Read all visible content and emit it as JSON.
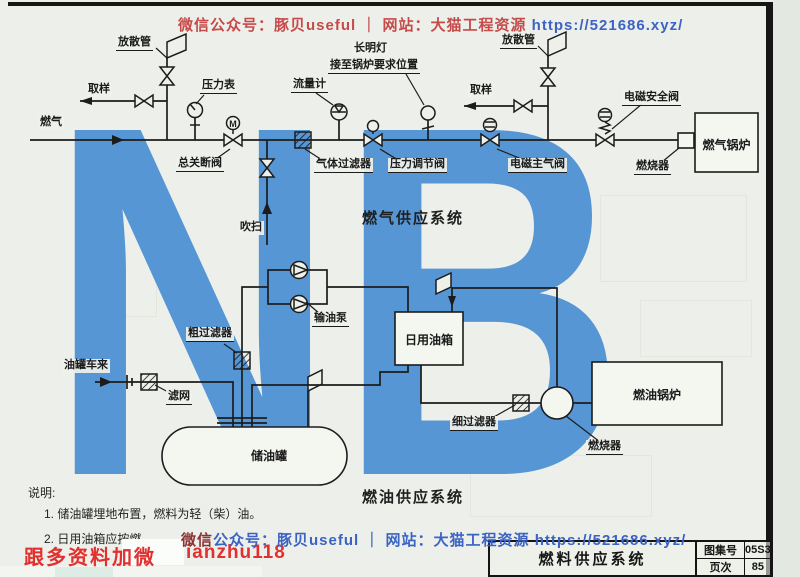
{
  "page": {
    "watermark_letters": "NB",
    "top_watermark": {
      "text_red": "微信公众号：豚贝useful ｜ 网站：大猫工程资源",
      "text_blue": " https://521686.xyz/"
    },
    "bottom_watermark": {
      "text_head": "微信",
      "text_blue": "公众号：豚贝useful ｜ 网站：大猫工程资源",
      "text_url": " https://521686.xyz/"
    },
    "promo": {
      "left": "跟多资料加微",
      "right": "ianzhu118"
    }
  },
  "gas_system": {
    "title": "燃气供应系统",
    "labels": {
      "vent_left": "放散管",
      "sample_left": "取样",
      "gas_inlet": "燃气",
      "pressure_gauge": "压力表",
      "main_shutoff_valve": "总关断阀",
      "purge": "吹扫",
      "gas_filter": "气体过滤器",
      "flow_meter": "流量计",
      "pilot_light": "长明灯",
      "pilot_light_note": "接至锅炉要求位置",
      "pressure_regulator": "压力调节阀",
      "sample_right": "取样",
      "vent_right": "放散管",
      "solenoid_main_valve": "电磁主气阀",
      "solenoid_safety_valve": "电磁安全阀",
      "burner": "燃烧器",
      "boiler": "燃气锅炉",
      "motor_letter": "M"
    }
  },
  "oil_system": {
    "title": "燃油供应系统",
    "labels": {
      "tanker": "油罐车来",
      "strainer": "滤网",
      "coarse_filter": "粗过滤器",
      "oil_pump": "输油泵",
      "daily_tank": "日用油箱",
      "storage_tank": "储油罐",
      "fine_filter": "细过滤器",
      "burner": "燃烧器",
      "boiler": "燃油锅炉"
    }
  },
  "notes": {
    "heading": "说明:",
    "item1": "1. 储油罐埋地布置，燃料为轻（柴）油。",
    "item2": "2. 日用油箱应按燃"
  },
  "title_block": {
    "title": "燃料供应系统",
    "atlas_label": "图集号",
    "atlas_value": "05S3",
    "page_label": "页次",
    "page_value": "85"
  },
  "colors": {
    "nb_blue": "#4e92d3",
    "watermark_red": "#c74a4a",
    "watermark_blue": "#3b63c4",
    "promo_red": "#e22f2f",
    "line_black": "#1c1c1c"
  }
}
